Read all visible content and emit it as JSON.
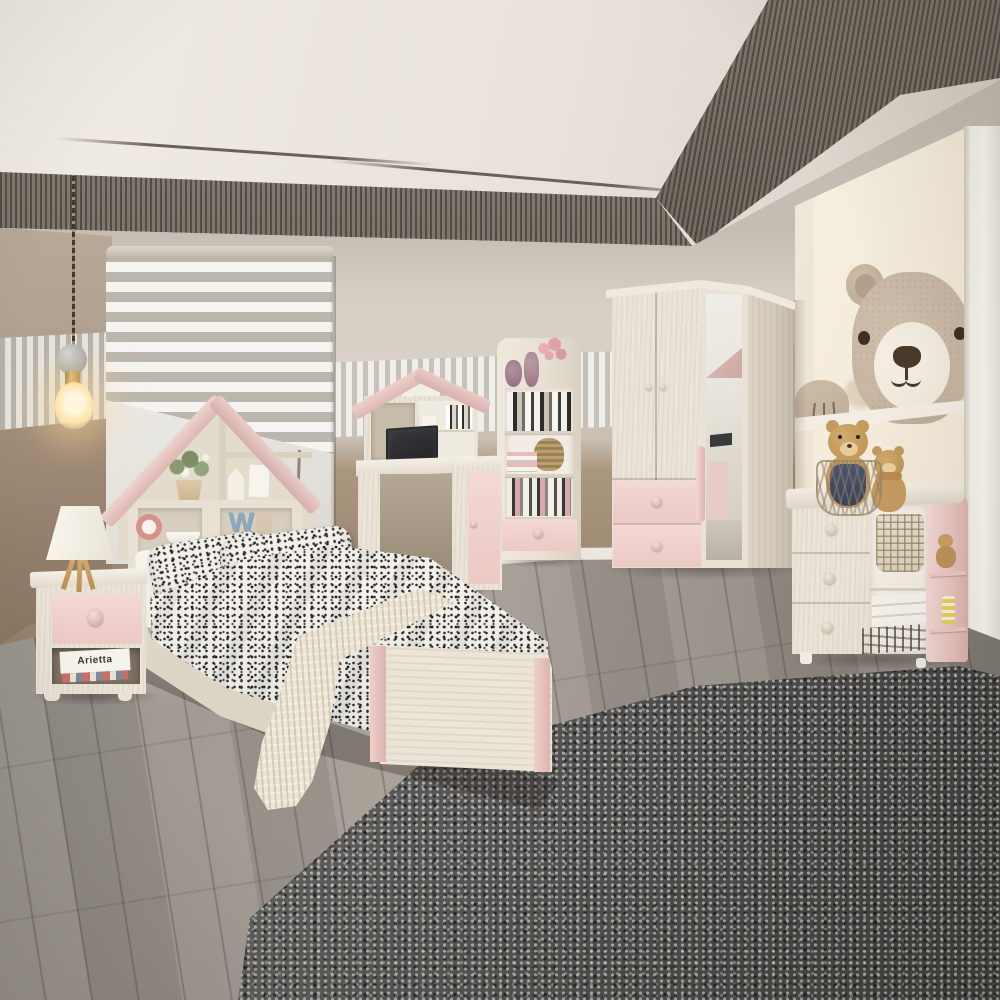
{
  "scene": {
    "type": "natural-photo",
    "setting": "Kids bedroom furniture set in whitewashed wood with blush pink accents, grey plank floor, shag rug, bear wall mural",
    "texts": {
      "book_spine": "Arietta",
      "headboard_letter": "W"
    },
    "palette": {
      "ceiling": "#ece7e1",
      "ceiling_slats": "#4a443c",
      "wall_upper_greige": "#d5cec5",
      "wall_lower_taupe": "#a5907c",
      "left_wall": "#95816e",
      "stripe_panel_light": "#efede8",
      "stripe_panel_grey": "#bcb7ae",
      "wood_light": "#e9e3d7",
      "accent_pink": "#f0d4d0",
      "floor_grey": "#968f87",
      "rug_grey": "#5e5d5a",
      "mural_panel": "#f5eedf",
      "bear_fur": "#c6b5a1",
      "bear_muzzle": "#f3ece2",
      "teddy_tan": "#c59c60",
      "lamp_glow": "#ffe3ab",
      "blind_grey": "#bcb7ae",
      "mirror": "#e8e4da"
    },
    "objects": [
      {
        "name": "pendant-bulb-light"
      },
      {
        "name": "zebra-roller-blind"
      },
      {
        "name": "window"
      },
      {
        "name": "house-headboard-bed"
      },
      {
        "name": "speckled-duvet-and-pillows"
      },
      {
        "name": "knit-throw-blanket"
      },
      {
        "name": "nightstand-with-pink-drawer"
      },
      {
        "name": "tripod-table-lamp"
      },
      {
        "name": "house-hutch-desk"
      },
      {
        "name": "laptop"
      },
      {
        "name": "bookshelf-with-pink-drawer"
      },
      {
        "name": "wardrobe-with-mirror-door"
      },
      {
        "name": "bear-wall-mural"
      },
      {
        "name": "dresser-with-pink-side-shelf"
      },
      {
        "name": "teddy-bears"
      },
      {
        "name": "grey-shag-rug"
      },
      {
        "name": "grey-plank-floor"
      }
    ]
  }
}
